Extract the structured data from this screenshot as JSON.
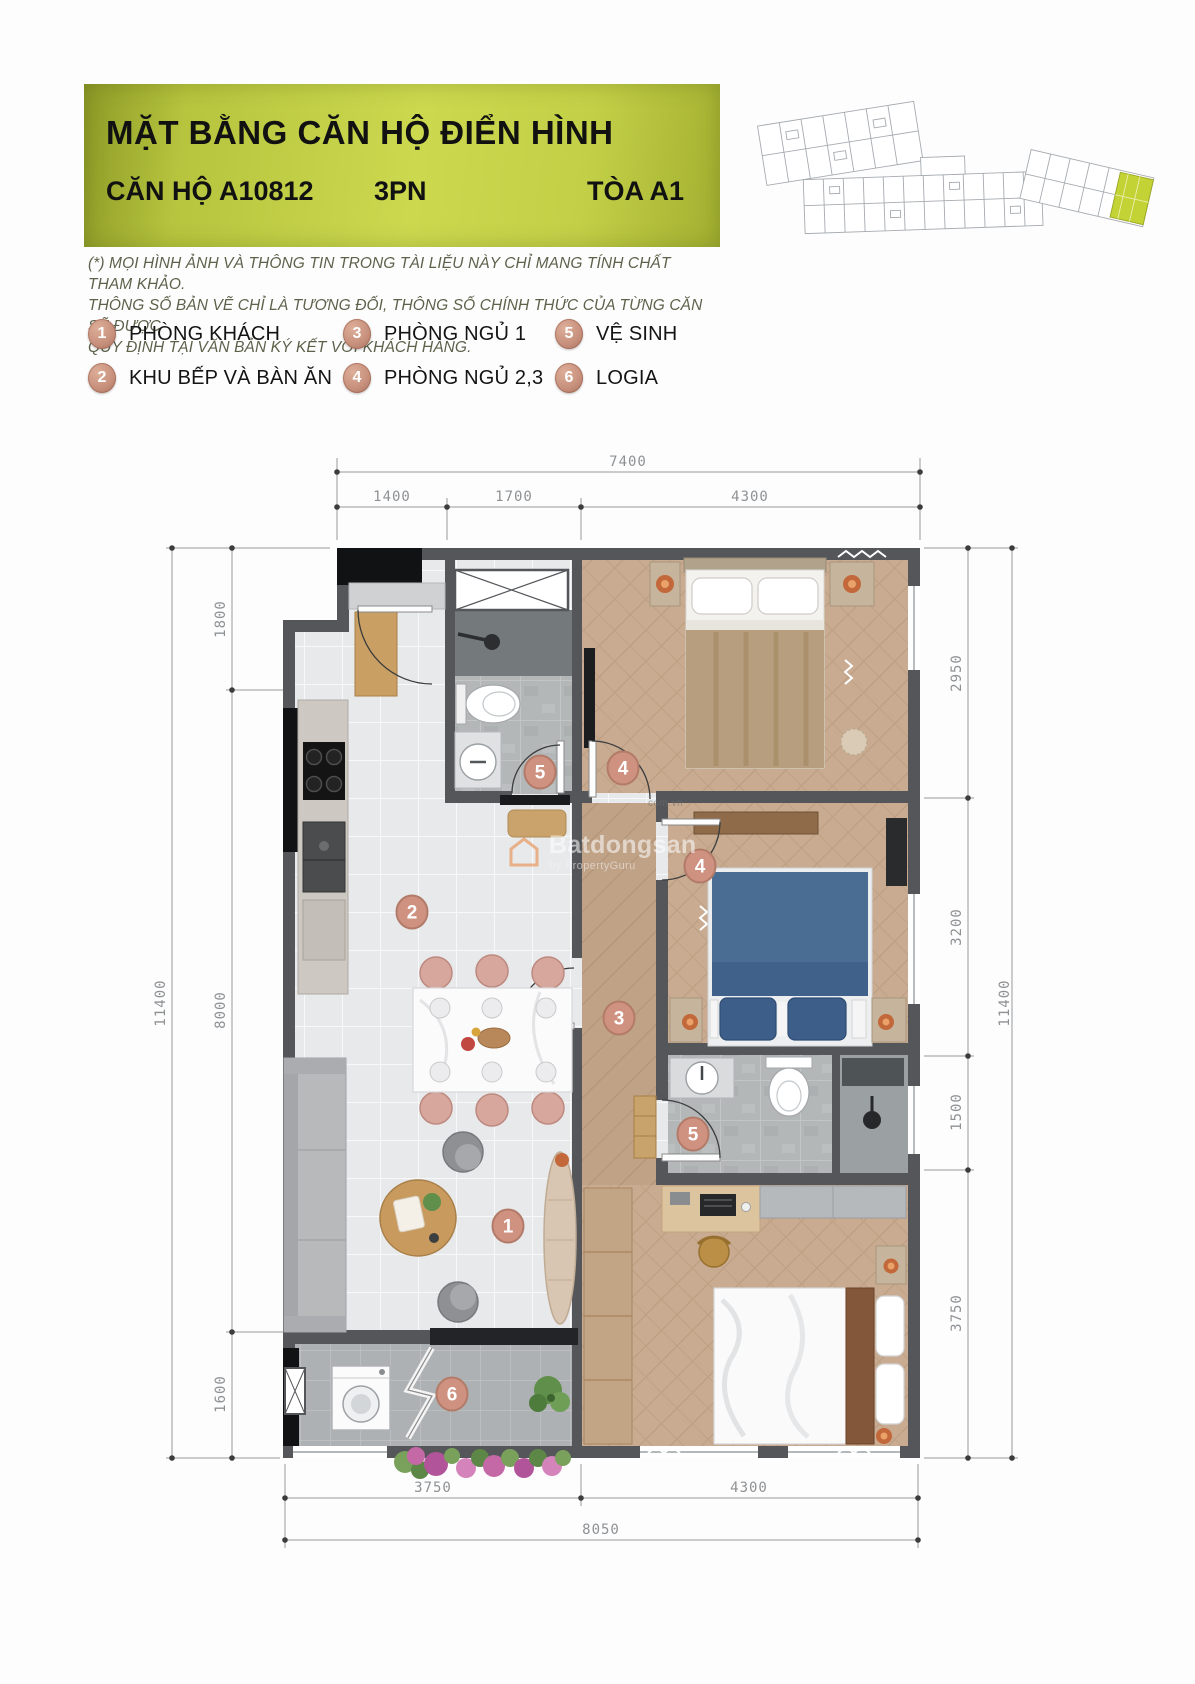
{
  "header": {
    "title": "MẶT BẰNG CĂN HỘ ĐIỂN HÌNH",
    "unit": "CĂN HỘ A10812",
    "bedrooms": "3PN",
    "tower": "TÒA A1"
  },
  "disclaimer": {
    "lines": [
      "(*) MỌI HÌNH ẢNH VÀ THÔNG TIN TRONG TÀI LIỆU NÀY CHỈ MANG TÍNH  CHẤT THAM KHẢO.",
      "THÔNG SỐ BẢN VẼ CHỈ LÀ TƯƠNG ĐỐI, THÔNG SỐ CHÍNH THỨC CỦA TỪNG CĂN SẼ ĐƯỢC",
      "QUY ĐỊNH TẠI VĂN BẢN KÝ KẾT VỚI KHÁCH HÀNG."
    ]
  },
  "legend": {
    "items": [
      {
        "num": "1",
        "label": "PHÒNG KHÁCH"
      },
      {
        "num": "2",
        "label": "KHU BẾP VÀ BÀN ĂN"
      },
      {
        "num": "3",
        "label": "PHÒNG NGỦ 1"
      },
      {
        "num": "4",
        "label": "PHÒNG NGỦ 2,3"
      },
      {
        "num": "5",
        "label": "VỆ SINH"
      },
      {
        "num": "6",
        "label": "LOGIA"
      }
    ]
  },
  "floor_plan": {
    "dimensions": {
      "top": {
        "overall": "7400",
        "segments": [
          "1400",
          "1700",
          "4300"
        ]
      },
      "bottom": {
        "overall": "8050",
        "segments": [
          "3750",
          "4300"
        ]
      },
      "left": {
        "overall": "11400",
        "segments": [
          "1800",
          "8000",
          "1600"
        ]
      },
      "right": {
        "overall": "11400",
        "segments": [
          "2950",
          "3200",
          "1500",
          "3750"
        ]
      }
    },
    "markers": [
      {
        "num": "2",
        "x": 412,
        "y": 912
      },
      {
        "num": "5",
        "x": 540,
        "y": 772
      },
      {
        "num": "4",
        "x": 623,
        "y": 768
      },
      {
        "num": "4",
        "x": 700,
        "y": 866
      },
      {
        "num": "3",
        "x": 619,
        "y": 1018
      },
      {
        "num": "5",
        "x": 693,
        "y": 1134
      },
      {
        "num": "1",
        "x": 508,
        "y": 1226
      },
      {
        "num": "6",
        "x": 452,
        "y": 1394
      }
    ],
    "marker_color": "#cf9180",
    "wall_color": "#54565a"
  },
  "watermark": {
    "brand": "Batdongsan",
    "byline": "by PropertyGuru",
    "domain": "com.vn"
  },
  "colors": {
    "header_green": "#c8d54b",
    "keyplan_highlight": "#c3d234",
    "marker_tan": "#cf9180"
  }
}
